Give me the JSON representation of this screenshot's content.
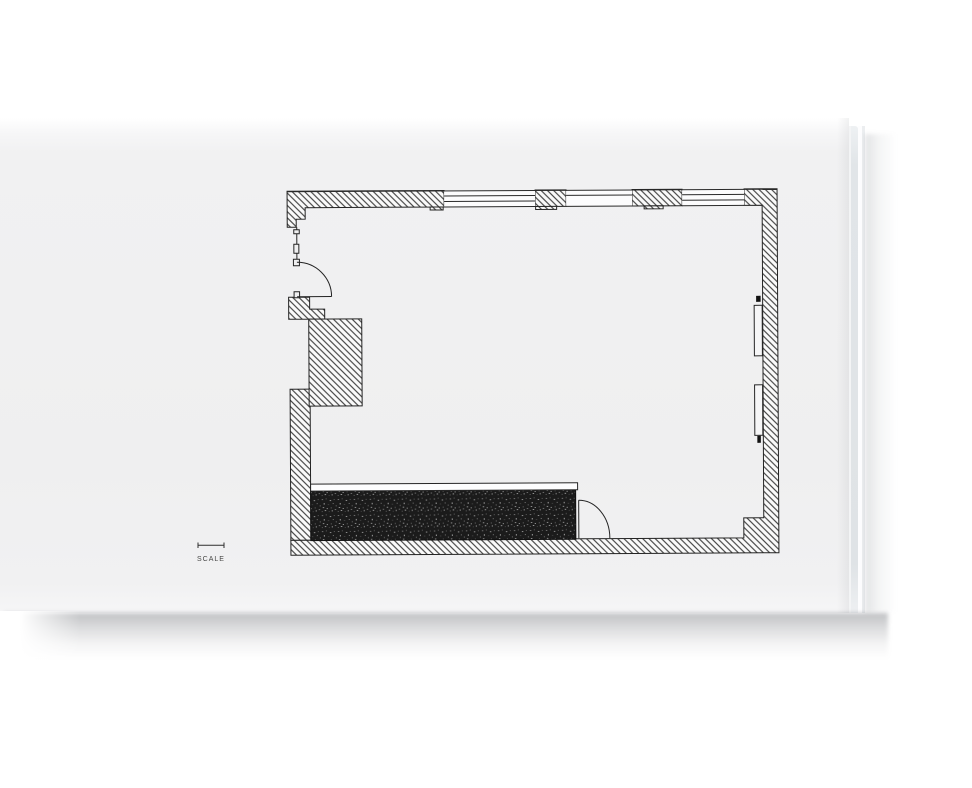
{
  "page": {
    "kind": "photographed book page with architectural floor plan",
    "background_color": "#efeff0",
    "ink_color": "#232323"
  },
  "scale_marker": {
    "label": "SCALE",
    "icon": "scale-bar-icon"
  },
  "drawing": {
    "type": "floor-plan",
    "features": [
      "hatched-exterior-walls",
      "top-wall-windows-3",
      "entry-door-with-swing-arc",
      "left-service-block",
      "dark-counter-bench",
      "counter-end-door-with-swing-arc",
      "right-wall-radiators-2",
      "bottom-right-wall-pier"
    ],
    "counter_fill_color": "#1b1b1b"
  }
}
